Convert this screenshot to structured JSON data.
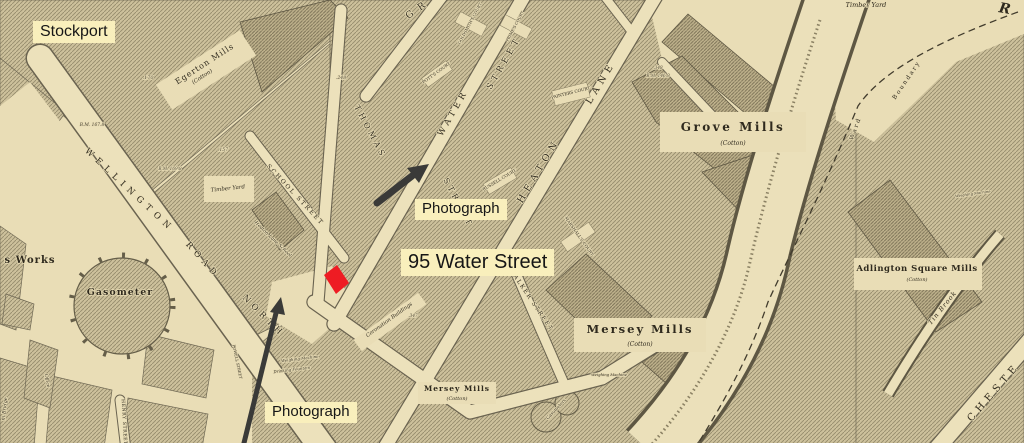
{
  "annotations": {
    "stockport": "Stockport",
    "water_street_95": "95 Water Street",
    "photograph_top": "Photograph",
    "photograph_bottom": "Photograph",
    "label_bg_color": "#f9efbc",
    "highlight_color": "#ee1c23",
    "arrow_color": "#3a3a38"
  },
  "map": {
    "streets": {
      "wellington": "WELLINGTON",
      "road": "ROAD",
      "north": "NORTH",
      "thomas": "THOMAS",
      "thomas_street": "STREET",
      "water": "WATER",
      "water_street": "STREET",
      "heaton": "HEATON",
      "lane": "LANE",
      "gr": "GR",
      "school_street": "SCHOOL STREET",
      "walker_street": "WALKER STREET",
      "henry_street": "HENRY STREET",
      "chester": "CHESTE",
      "goldsmiths_court": "GOLDSMITH'S COURT",
      "primes_court": "PRIME'S COURT",
      "potts_court": "POTT'S COURT",
      "painters_court": "PAINTERS COURT",
      "russell_court": "RUSSELL COURT",
      "marshalls_court": "MARSHALL'S COURT",
      "powell_street": "POWELL STREET"
    },
    "places": {
      "egerton_mills": "Egerton Mills",
      "grove_mills": "Grove Mills",
      "mersey_mills": "Mersey Mills",
      "mersey_mills_small": "Mersey Mills",
      "adlington_mills": "Adlington Square Mills",
      "cotton": "(Cotton)",
      "gasometer": "Gasometer",
      "gasometers": "Gasometers",
      "works": "s Works",
      "office": "Office",
      "timber_yard": "Timber Yard",
      "timber_yard_2": "Timber Yard",
      "heaton_lane_school": "Heaton Lane School",
      "coronation_buildings": "Coronation Buildings",
      "weighing_machine": "Weighing Machine",
      "drinking_fountain": "Drinking Fountain",
      "ward": "Ward",
      "boundary": "Boundary",
      "tin_brook": "Tin Brook",
      "river_initial": "R",
      "bridge": "m Bridge"
    },
    "numbers": {
      "n170": ".170",
      "bm167": "B.M. 167.8",
      "n157": ".157",
      "bm169": "B.M. 169.8",
      "n248": ".248",
      "n348": ".348",
      "bm146": "B.M. 146.9",
      "n347": ".347"
    },
    "colors": {
      "paper": "#e9ddb6",
      "building": "#cdc19c",
      "ink": "#2f2a1e"
    }
  }
}
